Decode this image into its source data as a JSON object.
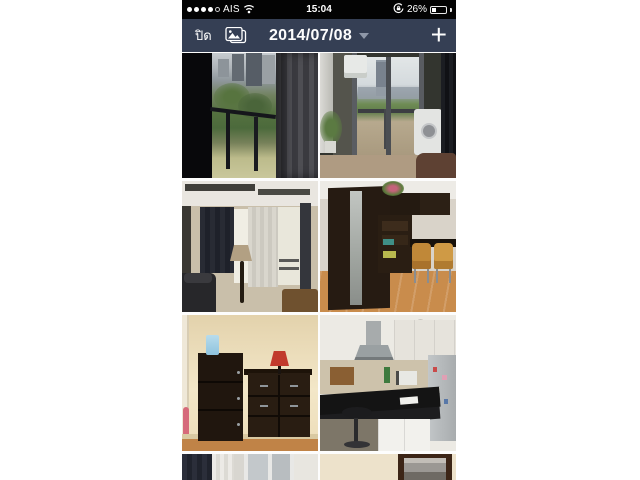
{
  "colors": {
    "status_bar_bg": "#030303",
    "nav_bar_bg": "#353f54",
    "page_bg": "#ffffff",
    "nav_text": "#fdfdfd"
  },
  "status_bar": {
    "carrier": "AIS",
    "time": "15:04",
    "battery_percent": "26%",
    "signal_dots_filled": 4,
    "signal_dots_total": 5,
    "icons": [
      "cellular-signal-dots-icon",
      "wifi-icon",
      "orientation-lock-icon",
      "battery-icon"
    ]
  },
  "nav_bar": {
    "close_label": "ปิด",
    "photos_icon": "photo-albums-icon",
    "date_label": "2014/07/08",
    "caret_icon": "chevron-down-icon",
    "add_label": "+"
  },
  "gallery": {
    "date_group": "2014/07/08",
    "photos": [
      {
        "desc": "Balcony city view through dark curtains with trees and railing"
      },
      {
        "desc": "Balcony sliding glass door with air conditioner, washing machine and city view"
      },
      {
        "desc": "Living room with floor lamp, navy curtain, sheer windows and dark sofa"
      },
      {
        "desc": "Study room with dark wood wardrobe, shelving, desk and two tan chairs"
      },
      {
        "desc": "Dark wood shoe cabinet and dresser with red lamp against cream wall"
      },
      {
        "desc": "Kitchen with black granite counter, range hood, white cabinets and refrigerator"
      },
      {
        "desc": "Window with dark and sheer curtains, partially visible"
      },
      {
        "desc": "Cream wall with dark framed mirror, partially visible"
      }
    ]
  }
}
